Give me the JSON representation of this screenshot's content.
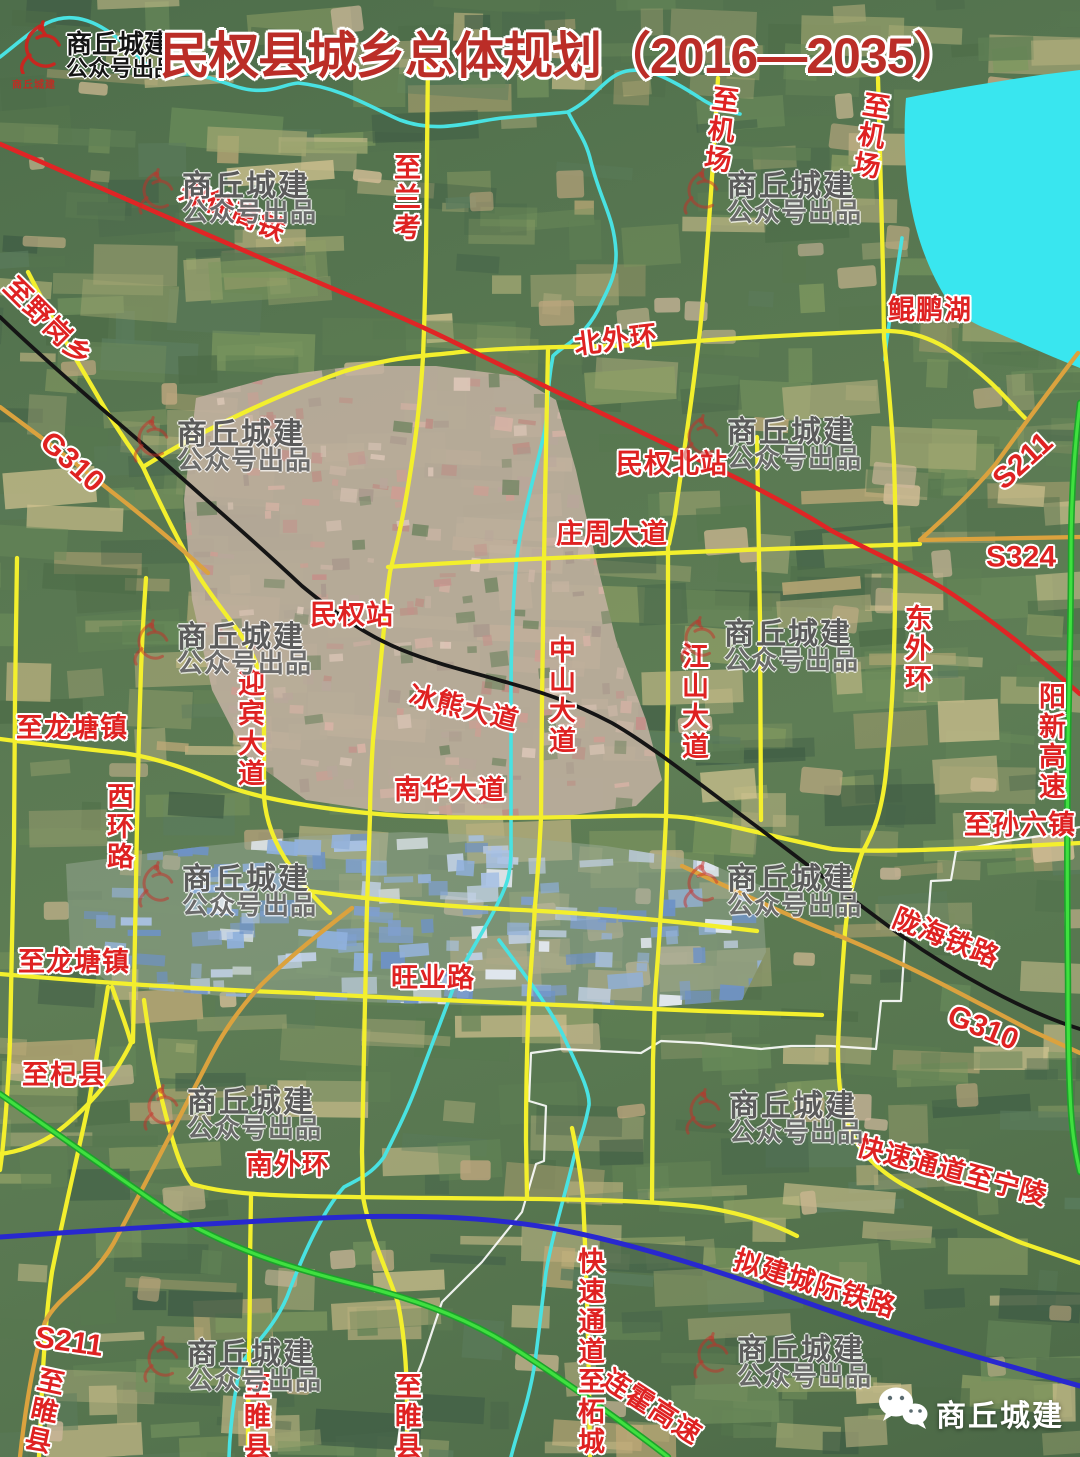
{
  "header": {
    "logo_title": "商丘城建",
    "logo_subtitle": "公众号出品",
    "logo_seal": "商丘城建",
    "title": "民权县城乡总体规划（2016—2035）"
  },
  "watermark": {
    "line1": "商丘城建",
    "line2": "公众号出品"
  },
  "footer": {
    "wechat_account": "商丘城建"
  },
  "map_colors": {
    "road": "#f3ef2d",
    "provincial_road": "#dba23e",
    "high_speed_rail": "#e02525",
    "railway": "#151515",
    "expressway": "#2ed02e",
    "planned_intercity_rail": "#2828cf",
    "river": "#49e2e2",
    "lake": "#39e6ef",
    "boundary": "#ffffff"
  },
  "map_labels": [
    {
      "name": "zhengxu-gaotie",
      "text": "郑徐高铁"
    },
    {
      "name": "zhi-yegangxiang",
      "text": "至野岗乡"
    },
    {
      "name": "g310-nw",
      "text": "G310"
    },
    {
      "name": "zhi-lankao",
      "text": "至兰考"
    },
    {
      "name": "zhi-jichang-w",
      "text": "至机场"
    },
    {
      "name": "zhi-jichang-e",
      "text": "至机场"
    },
    {
      "name": "kunpeng-hu",
      "text": "鲲鹏湖"
    },
    {
      "name": "bei-waihuan",
      "text": "北外环"
    },
    {
      "name": "minquan-beizhan",
      "text": "民权北站"
    },
    {
      "name": "zhuangzhou-dadao",
      "text": "庄周大道"
    },
    {
      "name": "s211-ne",
      "text": "S211"
    },
    {
      "name": "s324",
      "text": "S324"
    },
    {
      "name": "minquan-zhan",
      "text": "民权站"
    },
    {
      "name": "dong-waihuan",
      "text": "东外环"
    },
    {
      "name": "zhongshan-dadao",
      "text": "中山大道"
    },
    {
      "name": "jiangshan-dadao",
      "text": "江山大道"
    },
    {
      "name": "bingxiong-dadao",
      "text": "冰熊大道"
    },
    {
      "name": "yingbin-dadao",
      "text": "迎宾大道"
    },
    {
      "name": "zhi-longtangzhen-n",
      "text": "至龙塘镇"
    },
    {
      "name": "xihuan-lu",
      "text": "西环路"
    },
    {
      "name": "yangxin-gaosu",
      "text": "阳新高速"
    },
    {
      "name": "nanhua-dadao",
      "text": "南华大道"
    },
    {
      "name": "zhi-sunliuzhen",
      "text": "至孙六镇"
    },
    {
      "name": "longhai-tielu",
      "text": "陇海铁路"
    },
    {
      "name": "zhi-longtangzhen-s",
      "text": "至龙塘镇"
    },
    {
      "name": "wangye-lu",
      "text": "旺业路"
    },
    {
      "name": "g310-se",
      "text": "G310"
    },
    {
      "name": "zhi-qixian",
      "text": "至杞县"
    },
    {
      "name": "kuaisu-tongdao-zhi-ningling",
      "text": "快速通道至宁陵"
    },
    {
      "name": "nan-waihuan",
      "text": "南外环"
    },
    {
      "name": "nijian-chengji-tielu",
      "text": "拟建城际铁路"
    },
    {
      "name": "s211-sw",
      "text": "S211"
    },
    {
      "name": "zhi-suixian-1",
      "text": "至睢县"
    },
    {
      "name": "zhi-suixian-2",
      "text": "至睢县"
    },
    {
      "name": "zhi-suixian-3",
      "text": "至睢县"
    },
    {
      "name": "kuaisu-tongdao-zhi-zhecheng",
      "text": "快速通道至柘城"
    },
    {
      "name": "lianhuo-gaosu",
      "text": "连霍高速"
    }
  ]
}
